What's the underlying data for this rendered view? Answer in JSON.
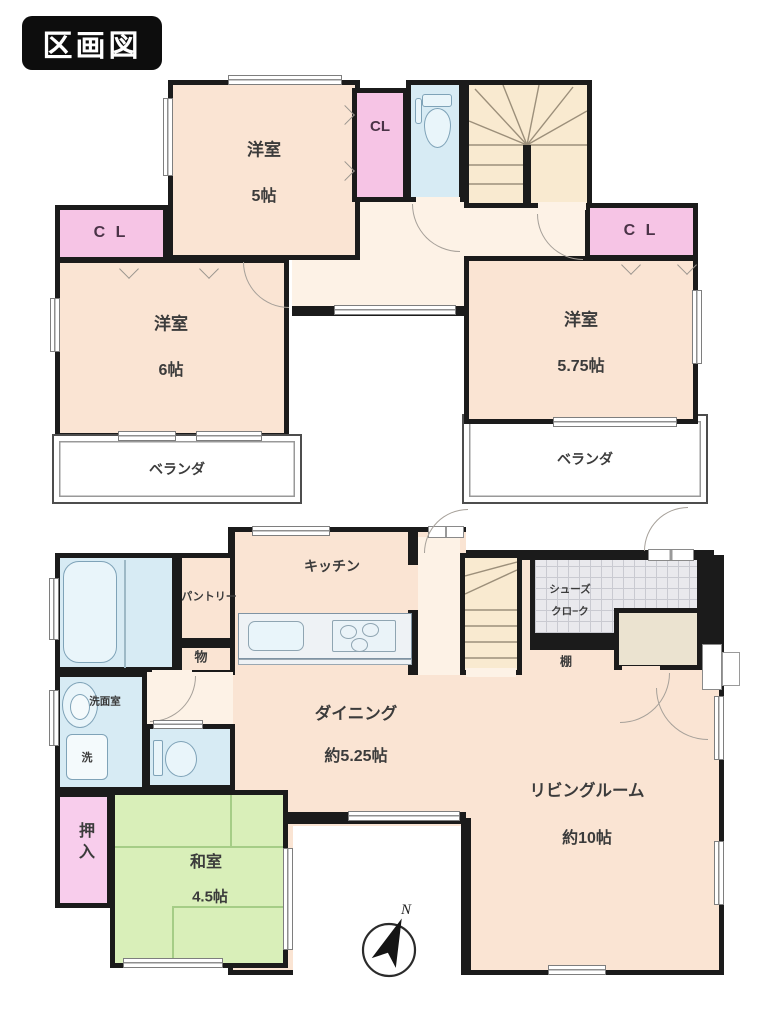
{
  "title": "区画図",
  "compass": {
    "north": "N"
  },
  "floor2f": {
    "room_a": {
      "name": "洋室",
      "size": "5帖"
    },
    "room_b": {
      "name": "洋室",
      "size": "6帖"
    },
    "room_c": {
      "name": "洋室",
      "size": "5.75帖"
    },
    "closet": "C L",
    "closet_stacked": "CL",
    "veranda": "ベランダ"
  },
  "floor1f": {
    "kitchen": "キッチン",
    "pantry": "パントリー",
    "storage": "物",
    "washroom": "洗面室",
    "laundry": "洗",
    "shoe_closet_line1": "シューズ",
    "shoe_closet_line2": "クロ−ク",
    "shelf": "棚",
    "dining": {
      "name": "ダイニング",
      "size": "約5.25帖"
    },
    "living": {
      "name": "リビングルーム",
      "size": "約10帖"
    },
    "oshiire": "押入",
    "japanese_room": {
      "name": "和室",
      "size": "4.5帖"
    }
  },
  "colors": {
    "wall": "#1b1b1b",
    "room_peach": "#fae4d3",
    "hall_cream": "#fdf2e6",
    "closet_pink": "#f6c4e5",
    "oshiire_pink": "#f8cdec",
    "wet_blue": "#d7ebf4",
    "tatami_green": "#d9efb9",
    "stairs_cream": "#f9ead0",
    "tile_gray": "#e9e9ed",
    "entrance_beige": "#ebe3d0"
  }
}
